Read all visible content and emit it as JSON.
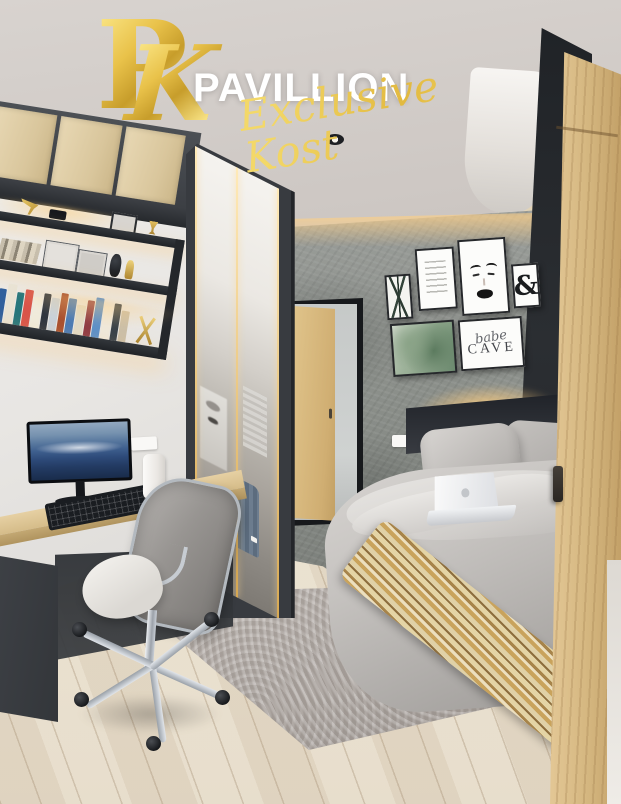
{
  "brand": {
    "monogram_p": "P",
    "monogram_k": "K",
    "name": "PAVILLION",
    "tagline": "Exclusive Kost",
    "colors": {
      "gold": "#E4BE3F",
      "gold_light": "#F6E386",
      "name_white": "#FFFFFF"
    }
  },
  "gallery_wall": {
    "ampersand_poster": "&",
    "babe_cave_poster": {
      "script_word": "babe",
      "caps_word": "CAVE"
    }
  }
}
